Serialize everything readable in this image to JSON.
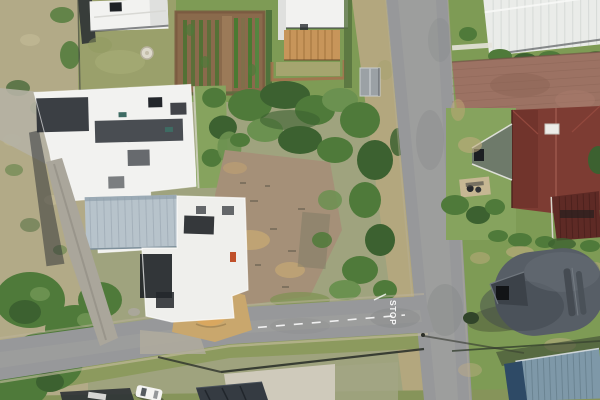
{
  "road_markings": {
    "stop": "STOP"
  },
  "palette": {
    "veld": "#b2aa87",
    "veld-green": "#5d7a42",
    "bush-dark": "#3c6130",
    "bush-mid": "#4f7a3a",
    "bush-light": "#6b9150",
    "lawn": "#7e9b55",
    "lawn-bright": "#86a35e",
    "lawn-dry": "#9aa06b",
    "verge-dry": "#b3a77e",
    "soil": "#8a6a4c",
    "crop-row": "#4c7233",
    "dirt": "#a59078",
    "sand": "#c9a76d",
    "sand-bright": "#d9a75f",
    "road": "#97989a",
    "road-light": "#a9a8a3",
    "road-dark": "#7e8082",
    "curb": "#c8bfa4",
    "white-roof": "#f2f2f0",
    "white-dim": "#dfe0de",
    "shadow": "#272b31",
    "metal-roof": "#b7c3cb",
    "metal-rib": "#a2afb9",
    "tile-orange": "#c7955a",
    "brick": "#9c7263",
    "red-roof": "#7d3c33",
    "red-roof-dark": "#692e28",
    "gable-gray": "#6e7a6a",
    "thatch": "#575e66",
    "thatch-dark": "#3f454c",
    "blue-roof": "#7e98a8",
    "blue-dark": "#2e4a66",
    "concrete": "#cfcabb",
    "marking": "#ffffff"
  }
}
